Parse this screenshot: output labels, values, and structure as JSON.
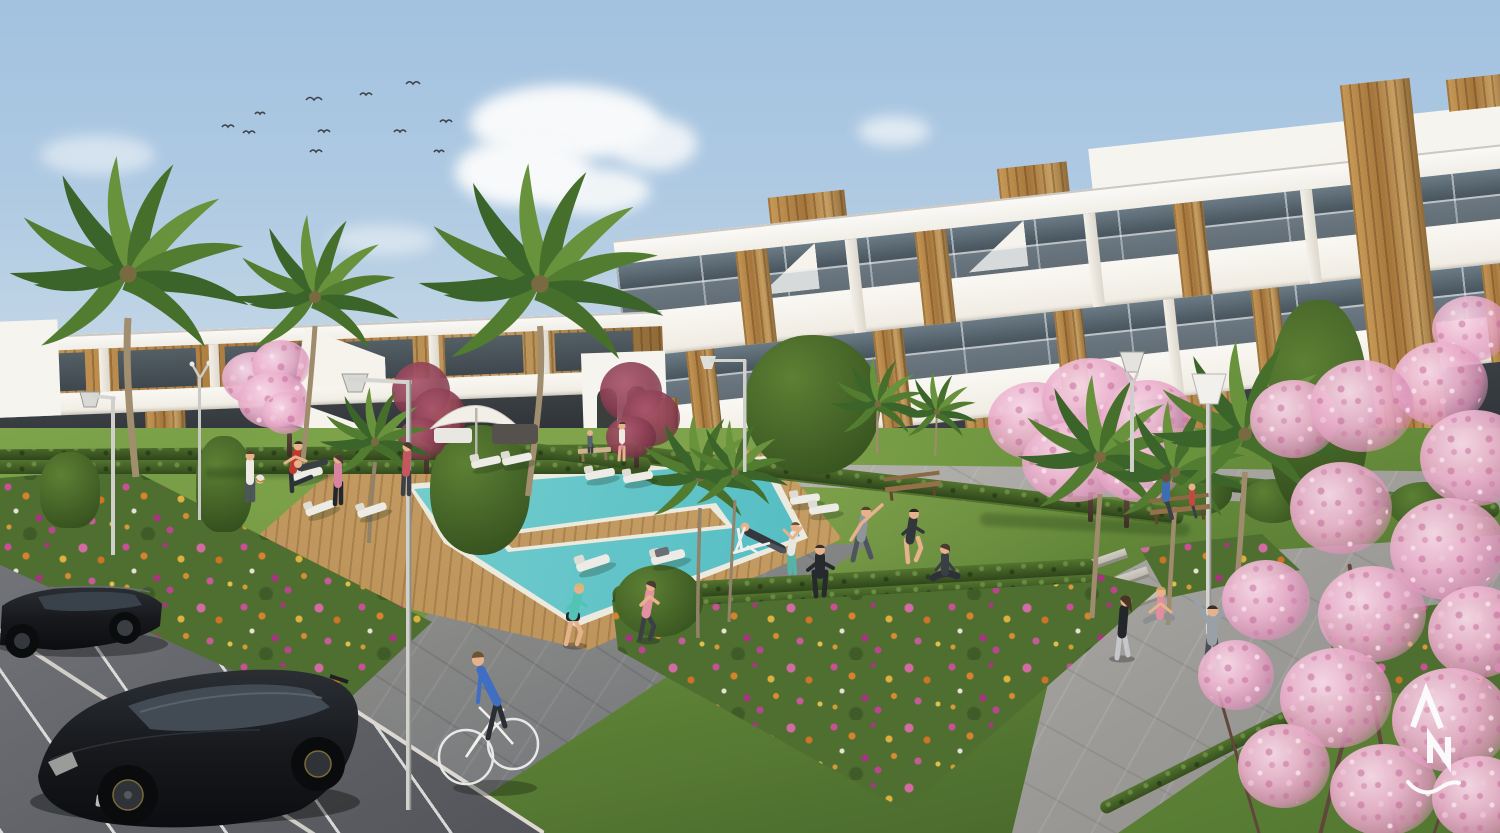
{
  "scene": {
    "title": "Sunny 3D architectural render of a new-build residential complex with communal pool, gardens and parking",
    "setting": "Modern white Mediterranean apartment blocks with wood-clad accents around a landscaped courtyard; residents exercise, jog and cycle; pink blossom trees and palm trees; turquoise pool with timber deck; dark cars in a parking area in the foreground",
    "watermark": {
      "letters": "AN",
      "style": "white monogram with swoosh, bottom-right"
    },
    "palette": {
      "sky_top": "#a2c2e0",
      "sky_horizon": "#e6ebec",
      "cloud": "#f7f9fa",
      "building_white": "#f6f4ee",
      "wood_accent": "#b8894a",
      "glass": "#47545c",
      "grass": "#6e953f",
      "hedge": "#3a5421",
      "pool_water": "#55bec4",
      "pool_shallow": "#a8e0da",
      "deck_wood": "#c9a269",
      "plaza_paving": "#b3b1ac",
      "path_dark": "#72747a",
      "asphalt": "#46484e",
      "parking_line": "#eeeeeb",
      "flower_pink": "#d16ba2",
      "flower_magenta": "#ae3384",
      "flower_orange": "#d8822e",
      "blossom_pink": "#e8aac6",
      "blossom_maroon": "#8e4153",
      "car_black": "#17191d",
      "lamp_white": "#dcdcd8",
      "skin": "#e6b28b"
    },
    "counts": {
      "birds": 11,
      "clouds": 9,
      "cars": 2,
      "people": 22,
      "palm_trees": 11,
      "blossom_trees": 5,
      "maroon_trees": 2,
      "sun_loungers": 11,
      "street_lamps": 6,
      "benches": 3,
      "parasols": 1,
      "pools": 1
    },
    "buildings": {
      "right_block": "three-storey white apartment building, staggered glass terraces, full-height timber tower, rooftop timber volumes",
      "left_block": "two-storey white building with dark timber cladding, external white staircases",
      "center_tower": "small white stair tower with arched openings"
    },
    "people": [
      {
        "name": "jogger-teal",
        "outfit": "#52c3b4 top, black shorts"
      },
      {
        "name": "jogger-pink",
        "outfit": "#e2919f top, dark capris"
      },
      {
        "name": "cyclist",
        "outfit": "#3f6ec2 sweater, white bicycle"
      },
      {
        "name": "deckchair-man",
        "outfit": "dark top, white deck chair"
      },
      {
        "name": "stretching-woman",
        "outfit": "white top, teal leggings"
      },
      {
        "name": "tracksuit-man",
        "outfit": "black tracksuit"
      },
      {
        "name": "side-stretch-man",
        "outfit": "grey tee, arm raised"
      },
      {
        "name": "athlete-dark",
        "outfit": "dark sportswear"
      },
      {
        "name": "yoga-woman",
        "outfit": "navy, seated cross-legged"
      },
      {
        "name": "football-kicker",
        "outfit": "red shirt"
      },
      {
        "name": "white-shirt-man",
        "outfit": "white shirt"
      },
      {
        "name": "pink-top-woman",
        "outfit": "pink top, black leggings"
      },
      {
        "name": "red-top-woman-deck",
        "outfit": "red top, dark leggings"
      },
      {
        "name": "walking-woman-right",
        "outfit": "black top, light leggings"
      },
      {
        "name": "sitting-woman-pink",
        "outfit": "pink vest"
      },
      {
        "name": "arms-up-stretcher",
        "outfit": "grey hoodie"
      },
      {
        "name": "bench-man-blue",
        "outfit": "blue jacket"
      },
      {
        "name": "bench-child-red",
        "outfit": "red top"
      },
      {
        "name": "mother-background",
        "outfit": "white top, pink skirt"
      },
      {
        "name": "child-background",
        "outfit": "dark top"
      },
      {
        "name": "lounger-sleeper",
        "outfit": "dark top"
      },
      {
        "name": "lounger-sitter",
        "outfit": "dark top on white recliner"
      }
    ],
    "vehicles": [
      {
        "name": "black-hatchback",
        "color": "#141619",
        "detail": "gold-rimmed alloys, parked foreground"
      },
      {
        "name": "black-sedan",
        "color": "#17191d",
        "detail": "parked, partially cropped left"
      }
    ],
    "amenities": [
      "communal swimming pool",
      "timber pool deck",
      "sun loungers",
      "white parasol with daybed",
      "park benches",
      "flower beds",
      "paved promenade",
      "parking bays"
    ]
  }
}
